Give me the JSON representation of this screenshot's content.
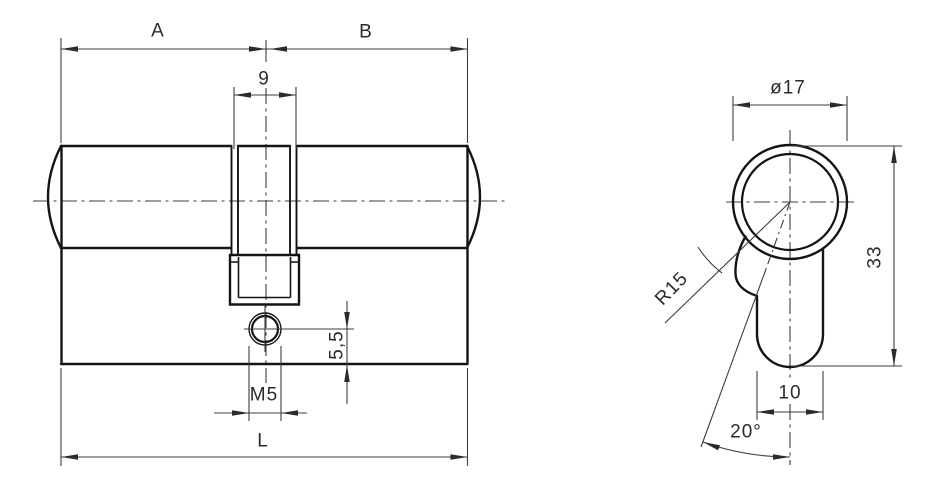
{
  "drawing": {
    "type": "technical-drawing",
    "subject": "double euro profile lock cylinder, front and side views",
    "background_color": "#ffffff",
    "object_line_color": "#141414",
    "dimension_line_color": "#3d3d3d",
    "text_color": "#2b2b2b",
    "front_view": {
      "dim_a": "A",
      "dim_b": "B",
      "dim_cam_slot_width": "9",
      "dim_screw_thread": "M5",
      "dim_screw_offset": "5,5",
      "dim_total_length": "L"
    },
    "side_view": {
      "dim_barrel_diameter": "ø17",
      "dim_profile_height": "33",
      "dim_body_width": "10",
      "dim_cam_angle": "20°",
      "dim_cam_radius": "R15"
    }
  }
}
